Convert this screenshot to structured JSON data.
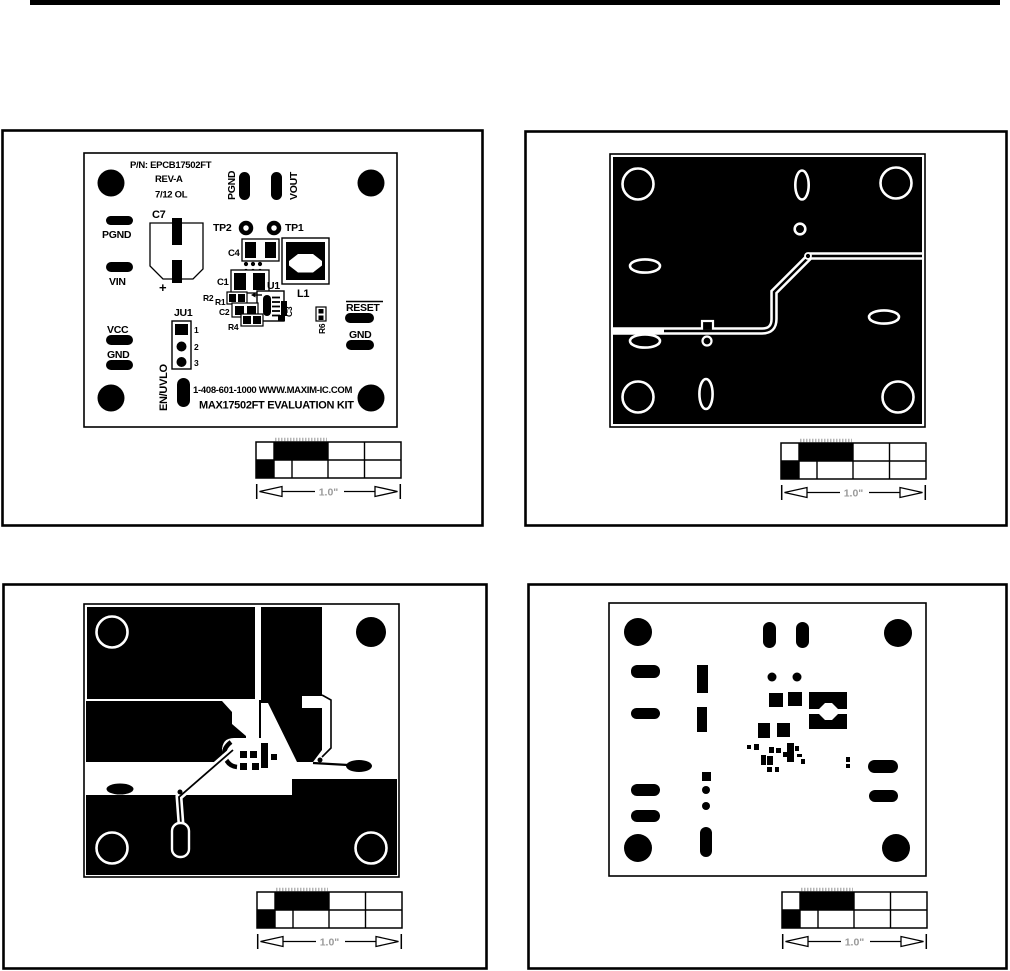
{
  "colors": {
    "ink": "#000000",
    "paper": "#ffffff",
    "dim_label": "#9a9a9a",
    "hatch": "#b5b5b5"
  },
  "scale": {
    "label": "1.0\""
  },
  "silkscreen": {
    "pn": "P/N: EPCB17502FT",
    "rev": "REV-A",
    "date": "7/12 OL",
    "pgnd_top": "PGND",
    "vout": "VOUT",
    "pgnd_left": "PGND",
    "vin": "VIN",
    "c7": "C7",
    "plus": "+",
    "tp2": "TP2",
    "tp1": "TP1",
    "c4": "C4",
    "c1": "C1",
    "u1": "U1",
    "l1": "L1",
    "r2": "R2",
    "r1": "R1",
    "c2": "C2",
    "r4": "R4",
    "c3": "C3",
    "r6": "R6",
    "reset": "RESET",
    "gnd_right": "GND",
    "vcc": "VCC",
    "gnd_left": "GND",
    "ju1": "JU1",
    "pin1": "1",
    "pin2": "2",
    "pin3": "3",
    "en_uvlo": "EN/UVLO",
    "contact": "1-408-601-1000 WWW.MAXIM-IC.COM",
    "kit": "MAX17502FT EVALUATION KIT"
  }
}
